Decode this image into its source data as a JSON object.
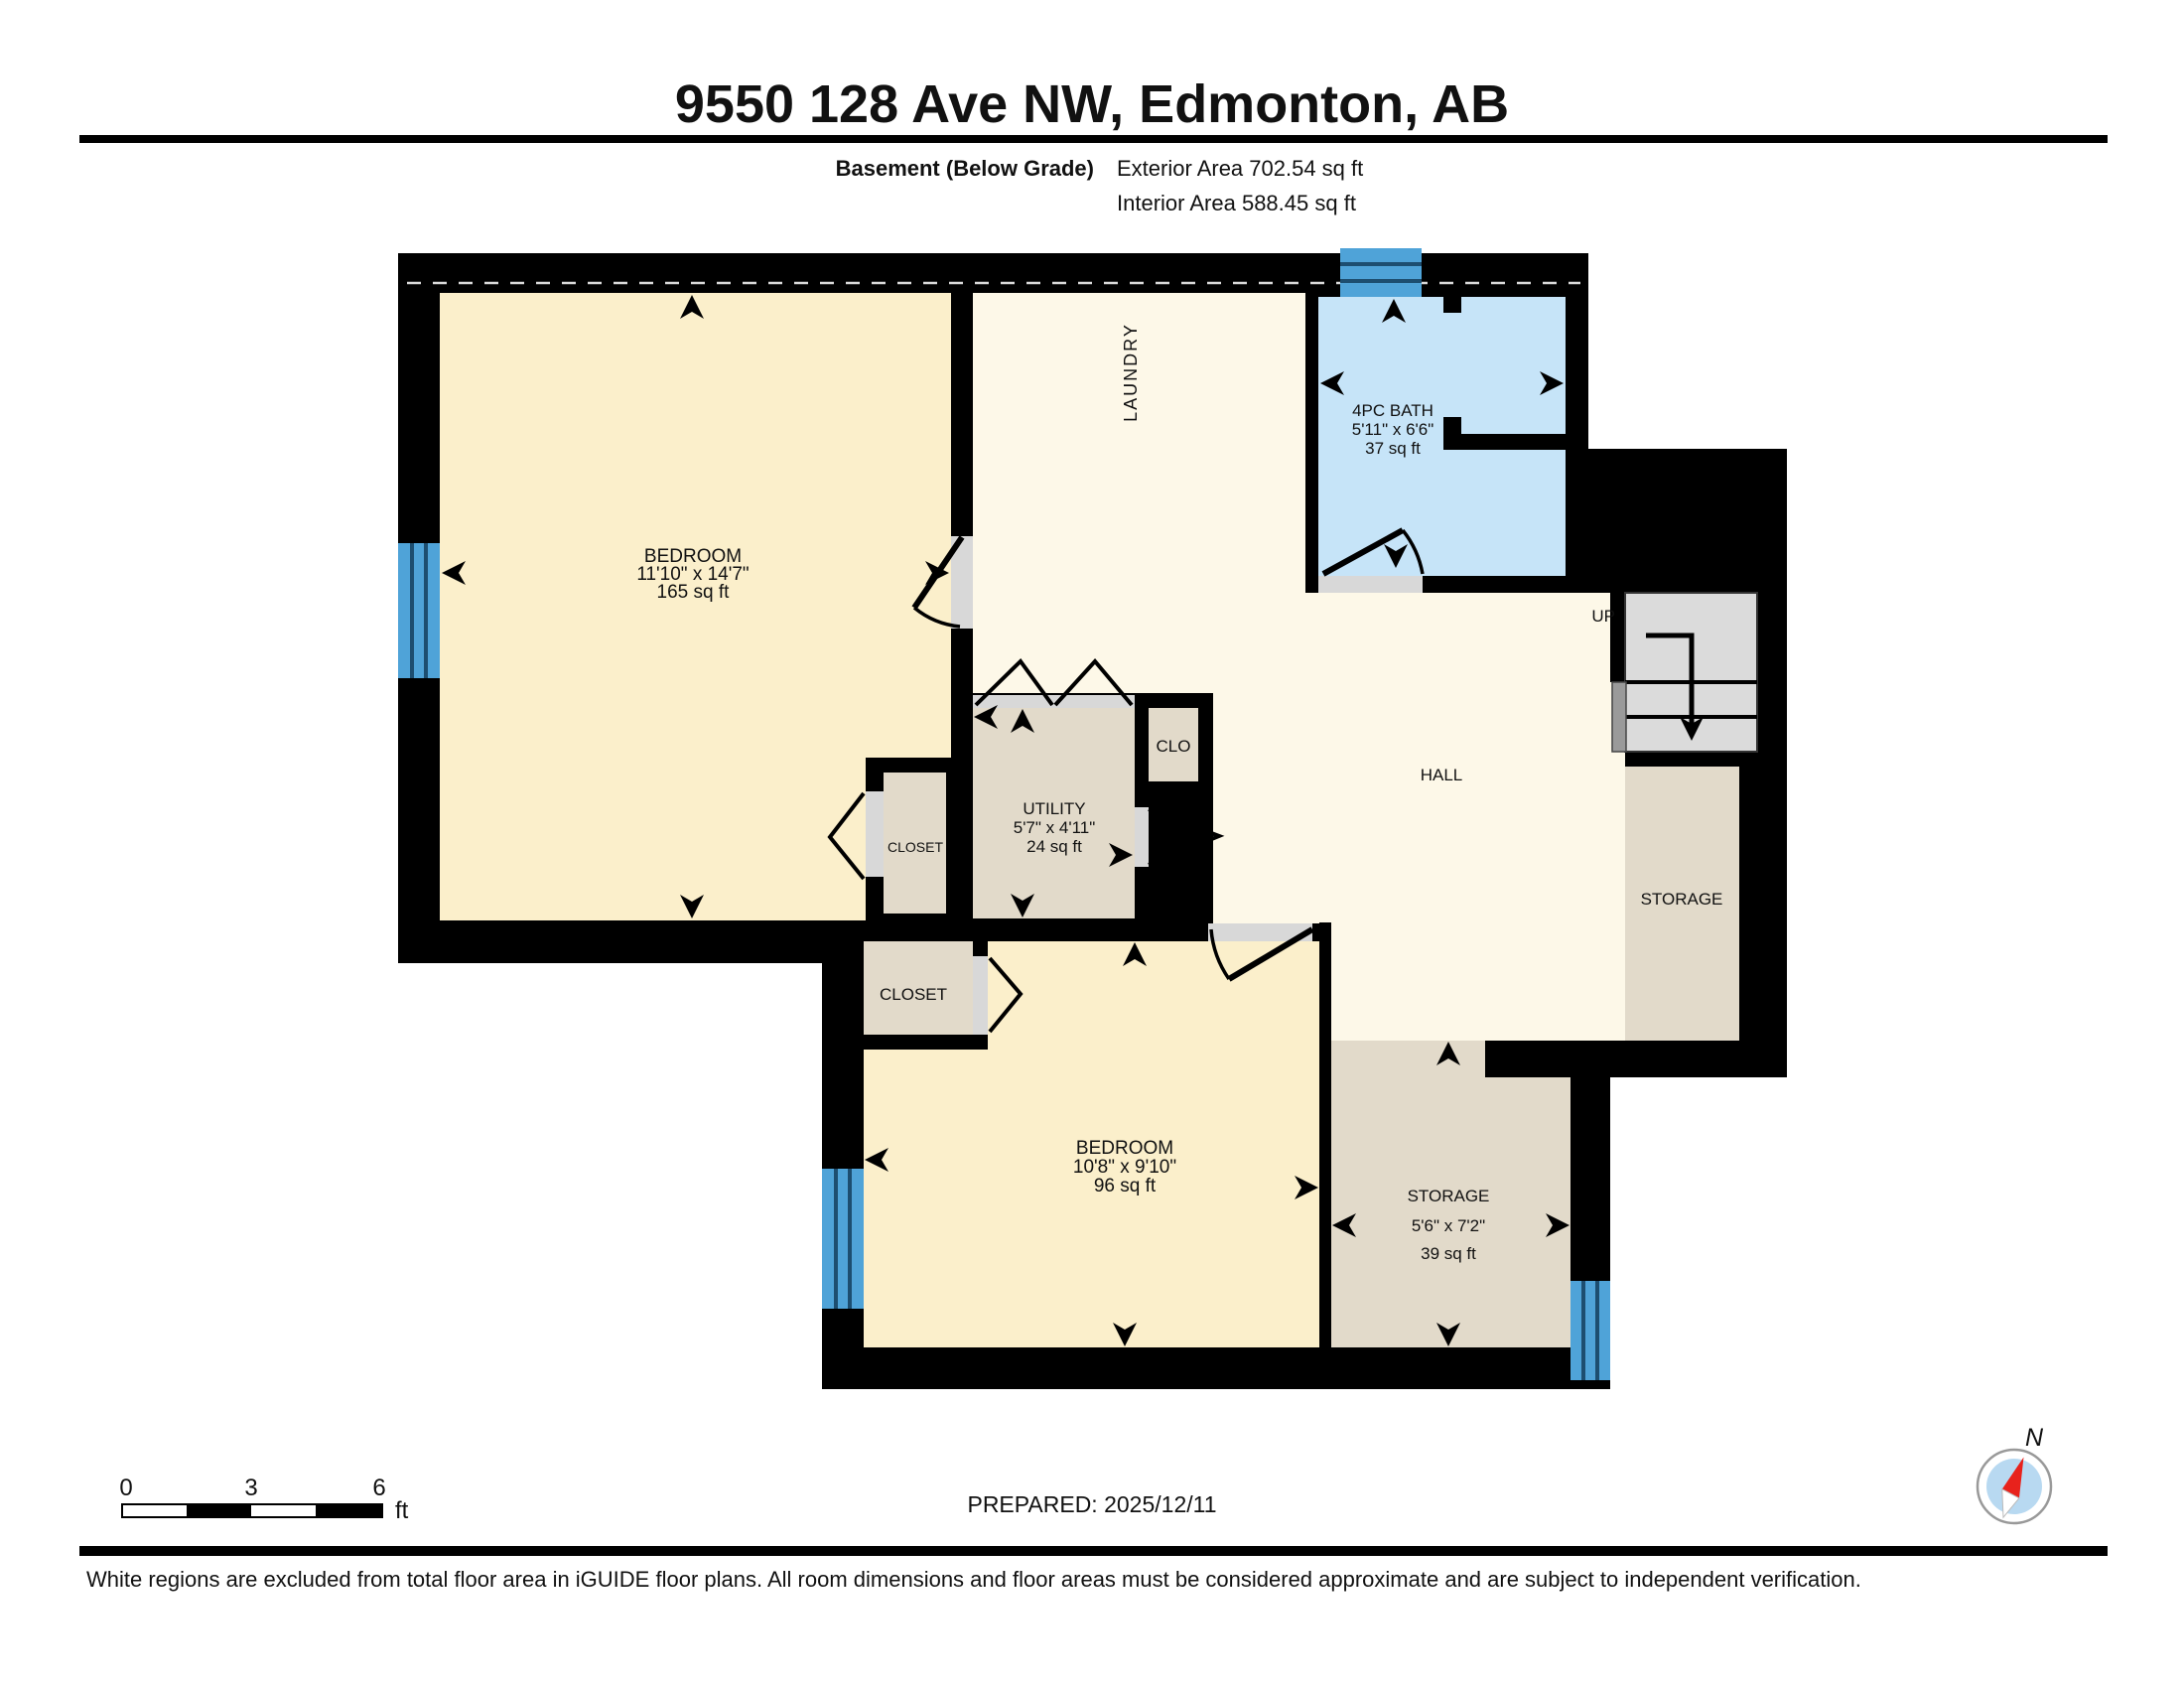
{
  "header": {
    "title": "9550 128 Ave NW, Edmonton, AB",
    "floor_label": "Basement (Below Grade)",
    "exterior_area": "Exterior Area 702.54 sq ft",
    "interior_area": "Interior Area 588.45 sq ft"
  },
  "rooms": {
    "bedroom1": {
      "name": "BEDROOM",
      "dims": "11'10\" x 14'7\"",
      "area": "165 sq ft"
    },
    "laundry": {
      "name": "LAUNDRY"
    },
    "bath": {
      "name": "4PC BATH",
      "dims": "5'11\" x 6'6\"",
      "area": "37 sq ft"
    },
    "hall": {
      "name": "HALL"
    },
    "stairs_label": "UP",
    "storage_upper": {
      "name": "STORAGE"
    },
    "utility": {
      "name": "UTILITY",
      "dims": "5'7\" x 4'11\"",
      "area": "24 sq ft"
    },
    "clo": {
      "name": "CLO"
    },
    "closet_mid": {
      "name": "CLOSET"
    },
    "closet_lower": {
      "name": "CLOSET"
    },
    "bedroom2": {
      "name": "BEDROOM",
      "dims": "10'8\" x 9'10\"",
      "area": "96 sq ft"
    },
    "storage_lower": {
      "name": "STORAGE",
      "dims": "5'6\" x 7'2\"",
      "area": "39 sq ft"
    }
  },
  "scale_bar": {
    "t0": "0",
    "t3": "3",
    "t6": "6",
    "unit": "ft"
  },
  "footer": {
    "prepared": "PREPARED: 2025/12/11",
    "disclaimer": "White regions are excluded from total floor area in iGUIDE floor plans. All room dimensions and floor areas must be considered approximate and are subject to independent verification."
  },
  "compass": {
    "n": "N"
  },
  "colors": {
    "wall": "#000000",
    "bedroom_floor": "#FBEFCB",
    "hall_floor": "#FDF8E8",
    "storage_floor": "#E2DACA",
    "bath_floor": "#C6E4F8",
    "window_blue": "#4FA3D8",
    "stairs_gray": "#DBDBDB",
    "compass_red": "#E8221C",
    "compass_blue": "#B8D9F1"
  }
}
